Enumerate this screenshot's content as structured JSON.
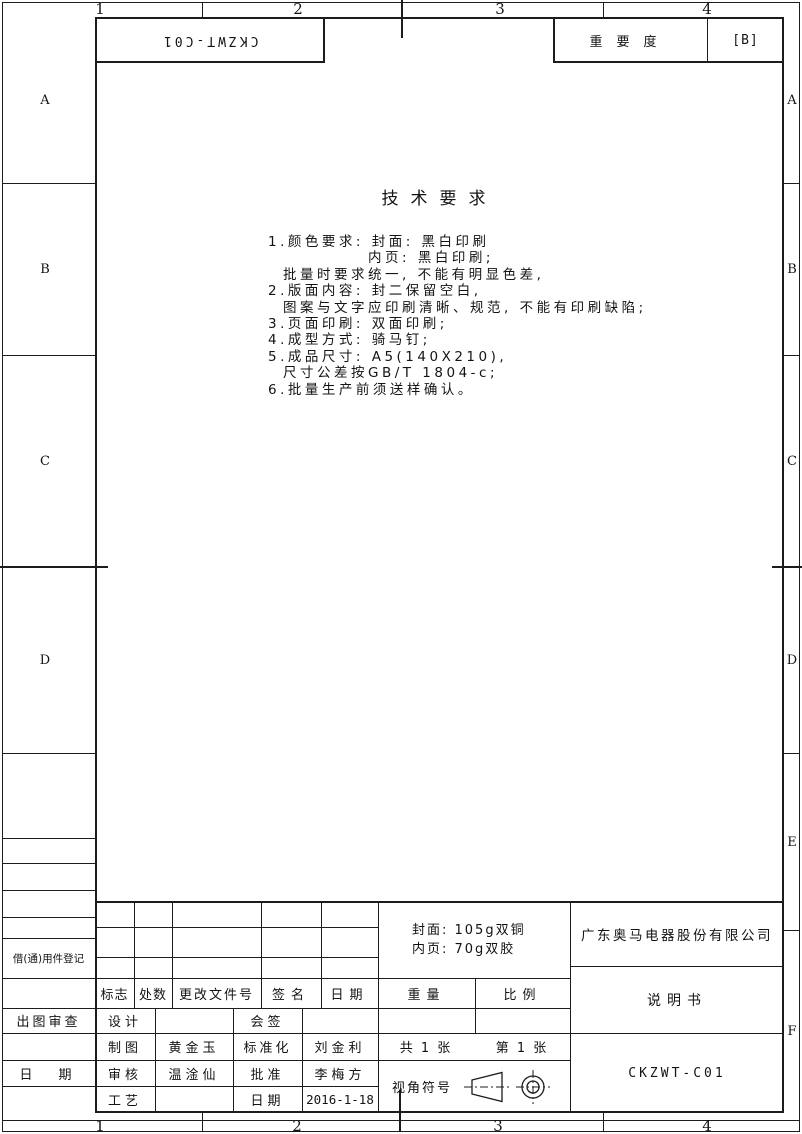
{
  "zones": {
    "top": [
      "1",
      "2",
      "3",
      "4"
    ],
    "bottom": [
      "1",
      "2",
      "3",
      "4"
    ],
    "left": [
      "A",
      "B",
      "C",
      "D"
    ],
    "right": [
      "A",
      "B",
      "C",
      "D",
      "E",
      "F"
    ]
  },
  "top_bar": {
    "reversed_code": "CKZWT-C01",
    "importance_label": "重要度",
    "importance_value": "[B]"
  },
  "tech_requirements": {
    "title": "技术要求",
    "lines": [
      "1.颜色要求: 封面: 黑白印刷",
      "内页: 黑白印刷;",
      "批量时要求统一, 不能有明显色差,",
      "2.版面内容: 封二保留空白,",
      "图案与文字应印刷清晰、规范, 不能有印刷缺陷;",
      "3.页面印刷: 双面印刷;",
      "4.成型方式: 骑马钉;",
      "5.成品尺寸: A5(140X210),",
      "尺寸公差按GB/T 1804-c;",
      "6.批量生产前须送样确认。"
    ]
  },
  "left_margin": {
    "borrow_register": "借(通)用件登记",
    "plot_review": "出图审查",
    "date_label": "日期"
  },
  "title_block": {
    "revision_header": {
      "mark": "标志",
      "count": "处数",
      "change_doc_no": "更改文件号",
      "signature": "签名",
      "date": "日期"
    },
    "signatures": {
      "design_label": "设计",
      "countersign_label": "会签",
      "draft_label": "制图",
      "draft_name": "黄金玉",
      "standardize_label": "标准化",
      "standardize_name": "刘金利",
      "check_label": "审核",
      "check_name": "温淦仙",
      "approve_label": "批准",
      "approve_name": "李梅方",
      "process_label": "工艺",
      "date_label": "日期",
      "date_value": "2016-1-18"
    },
    "material": {
      "cover": "封面: 105g双铜",
      "inner": "内页: 70g双胶"
    },
    "weight_label": "重量",
    "scale_label": "比例",
    "sheets_total": "共 1 张",
    "sheet_no": "第 1 张",
    "view_symbol_label": "视角符号",
    "company": "广东奥马电器股份有限公司",
    "doc_title": "说明书",
    "doc_number": "CKZWT-C01"
  },
  "colors": {
    "line": "#1c1c1c",
    "paper": "#ffffff"
  }
}
